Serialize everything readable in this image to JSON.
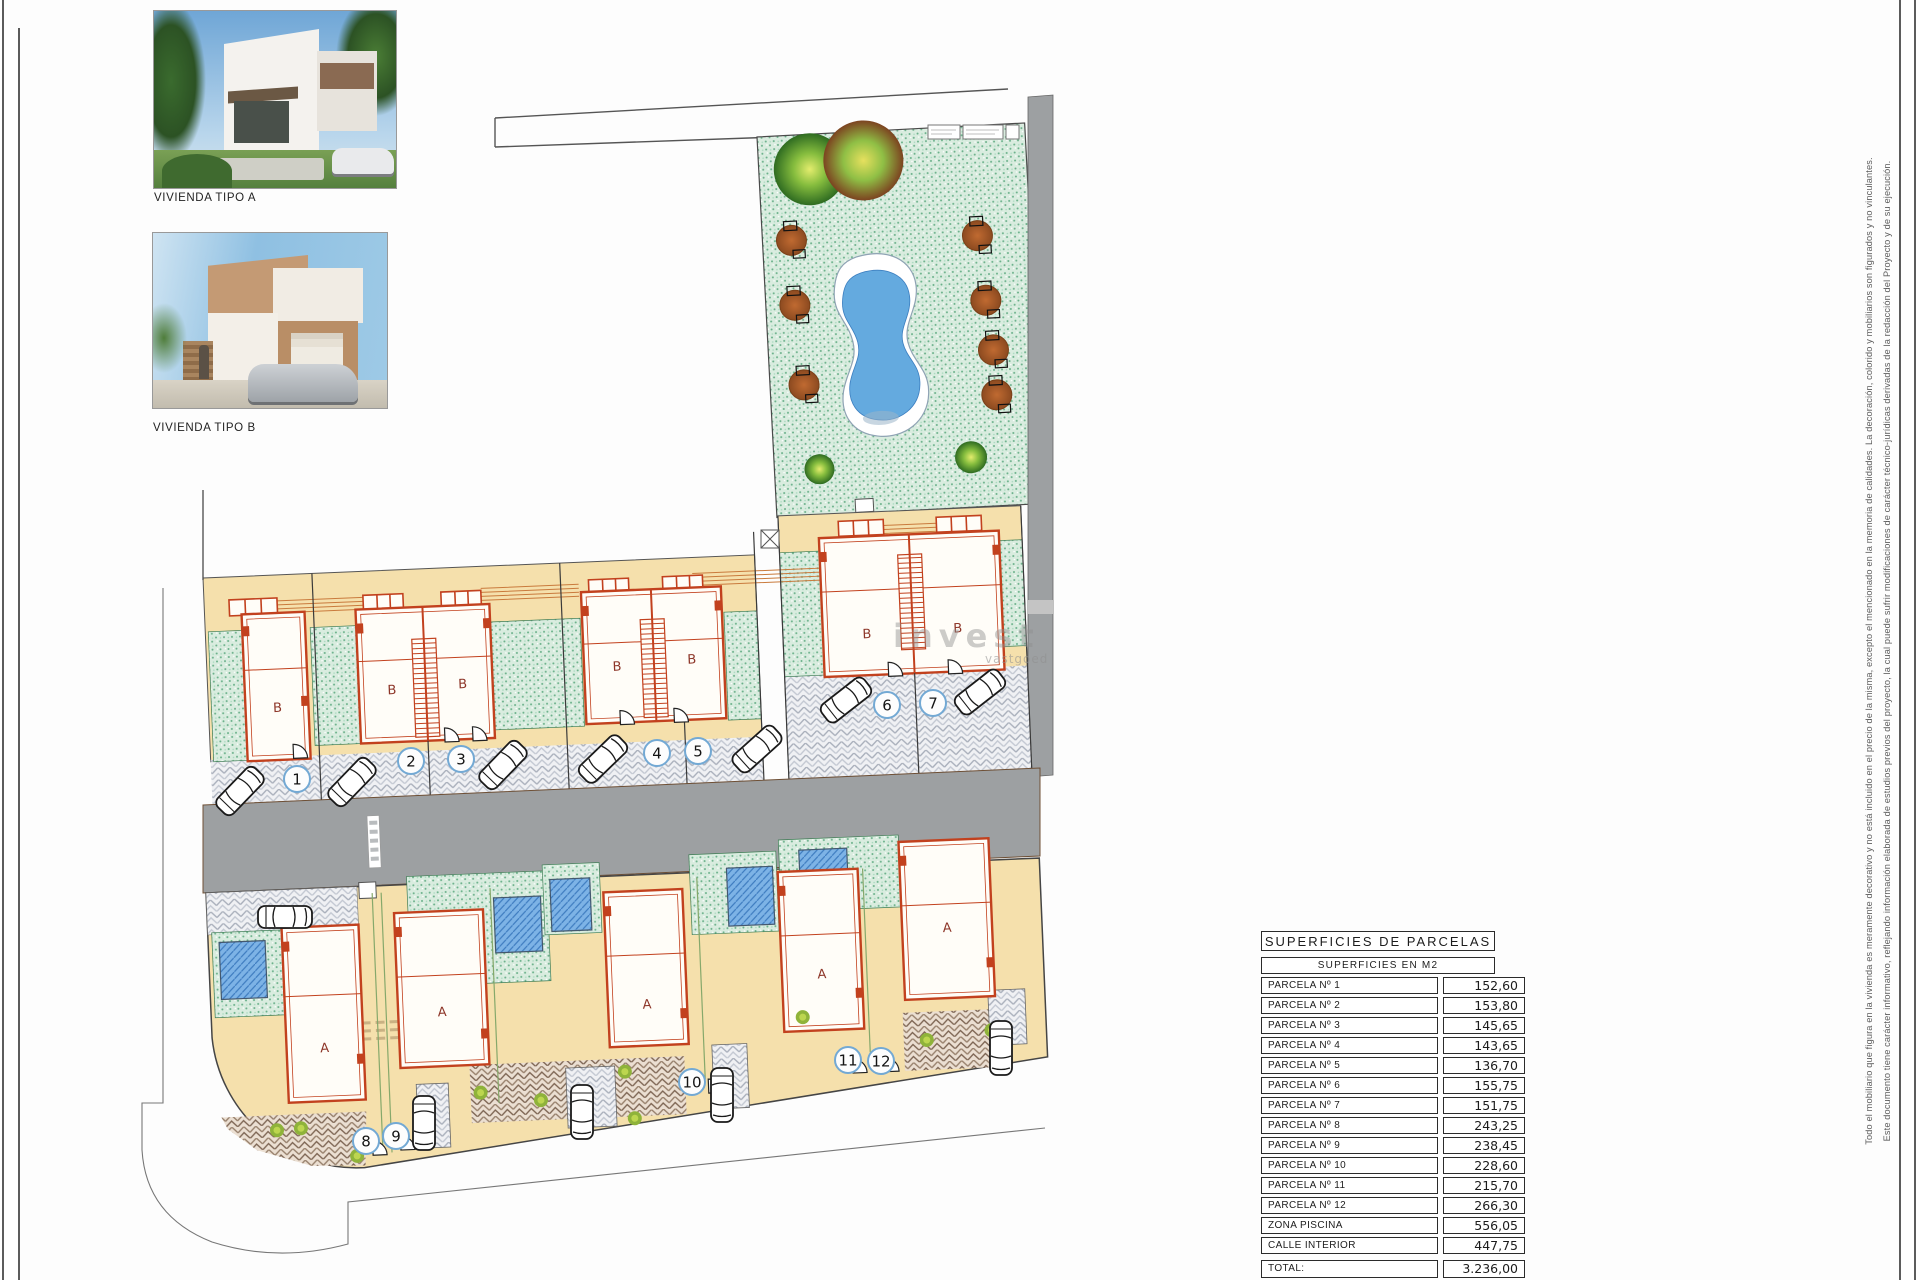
{
  "photos": {
    "caption_a": "VIVIENDA TIPO A",
    "caption_b": "VIVIENDA TIPO B"
  },
  "plan": {
    "house_letter_a": "A",
    "house_letter_b": "B",
    "parcel_numbers": [
      "1",
      "2",
      "3",
      "4",
      "5",
      "6",
      "7",
      "8",
      "9",
      "10",
      "11",
      "12"
    ],
    "watermark": {
      "text": "invest",
      "subtext": "vastgoed"
    }
  },
  "table": {
    "title": "SUPERFICIES  DE  PARCELAS",
    "subtitle": "SUPERFICIES  EN  M2",
    "rows": [
      {
        "label": "PARCELA  Nº  1",
        "value": "152,60"
      },
      {
        "label": "PARCELA  Nº  2",
        "value": "153,80"
      },
      {
        "label": "PARCELA  Nº  3",
        "value": "145,65"
      },
      {
        "label": "PARCELA  Nº  4",
        "value": "143,65"
      },
      {
        "label": "PARCELA  Nº  5",
        "value": "136,70"
      },
      {
        "label": "PARCELA  Nº  6",
        "value": "155,75"
      },
      {
        "label": "PARCELA  Nº  7",
        "value": "151,75"
      },
      {
        "label": "PARCELA  Nº  8",
        "value": "243,25"
      },
      {
        "label": "PARCELA  Nº  9",
        "value": "238,45"
      },
      {
        "label": "PARCELA  Nº  10",
        "value": "228,60"
      },
      {
        "label": "PARCELA  Nº  11",
        "value": "215,70"
      },
      {
        "label": "PARCELA  Nº  12",
        "value": "266,30"
      },
      {
        "label": "ZONA  PISCINA",
        "value": "556,05"
      },
      {
        "label": "CALLE  INTERIOR",
        "value": "447,75"
      }
    ],
    "total_label": "TOTAL:",
    "total_value": "3.236,00"
  },
  "disclaimer": {
    "line1": "Este documento tiene carácter informativo, reflejando información elaborada de estudios previos del proyecto, la cual puede sufrir modificaciones de carácter técnico-jurídicas derivadas de la redacción del Proyecto y de su ejecución.",
    "line2": "Todo el mobiliario que figura en la vivienda es meramente decorativo y no está incluido en el precio de la misma, excepto el mencionado en la memoria de calidades. La decoración, colorido y mobiliarios son figurados y no vinculantes."
  },
  "colors": {
    "parcel_tan": "#f5e0ac",
    "garden_green": "#d9ecdf",
    "house_red": "#c2411e",
    "pool_blue": "#7db3e6",
    "road_gray": "#9da0a2",
    "number_circle_blue": "#73a9d4"
  }
}
